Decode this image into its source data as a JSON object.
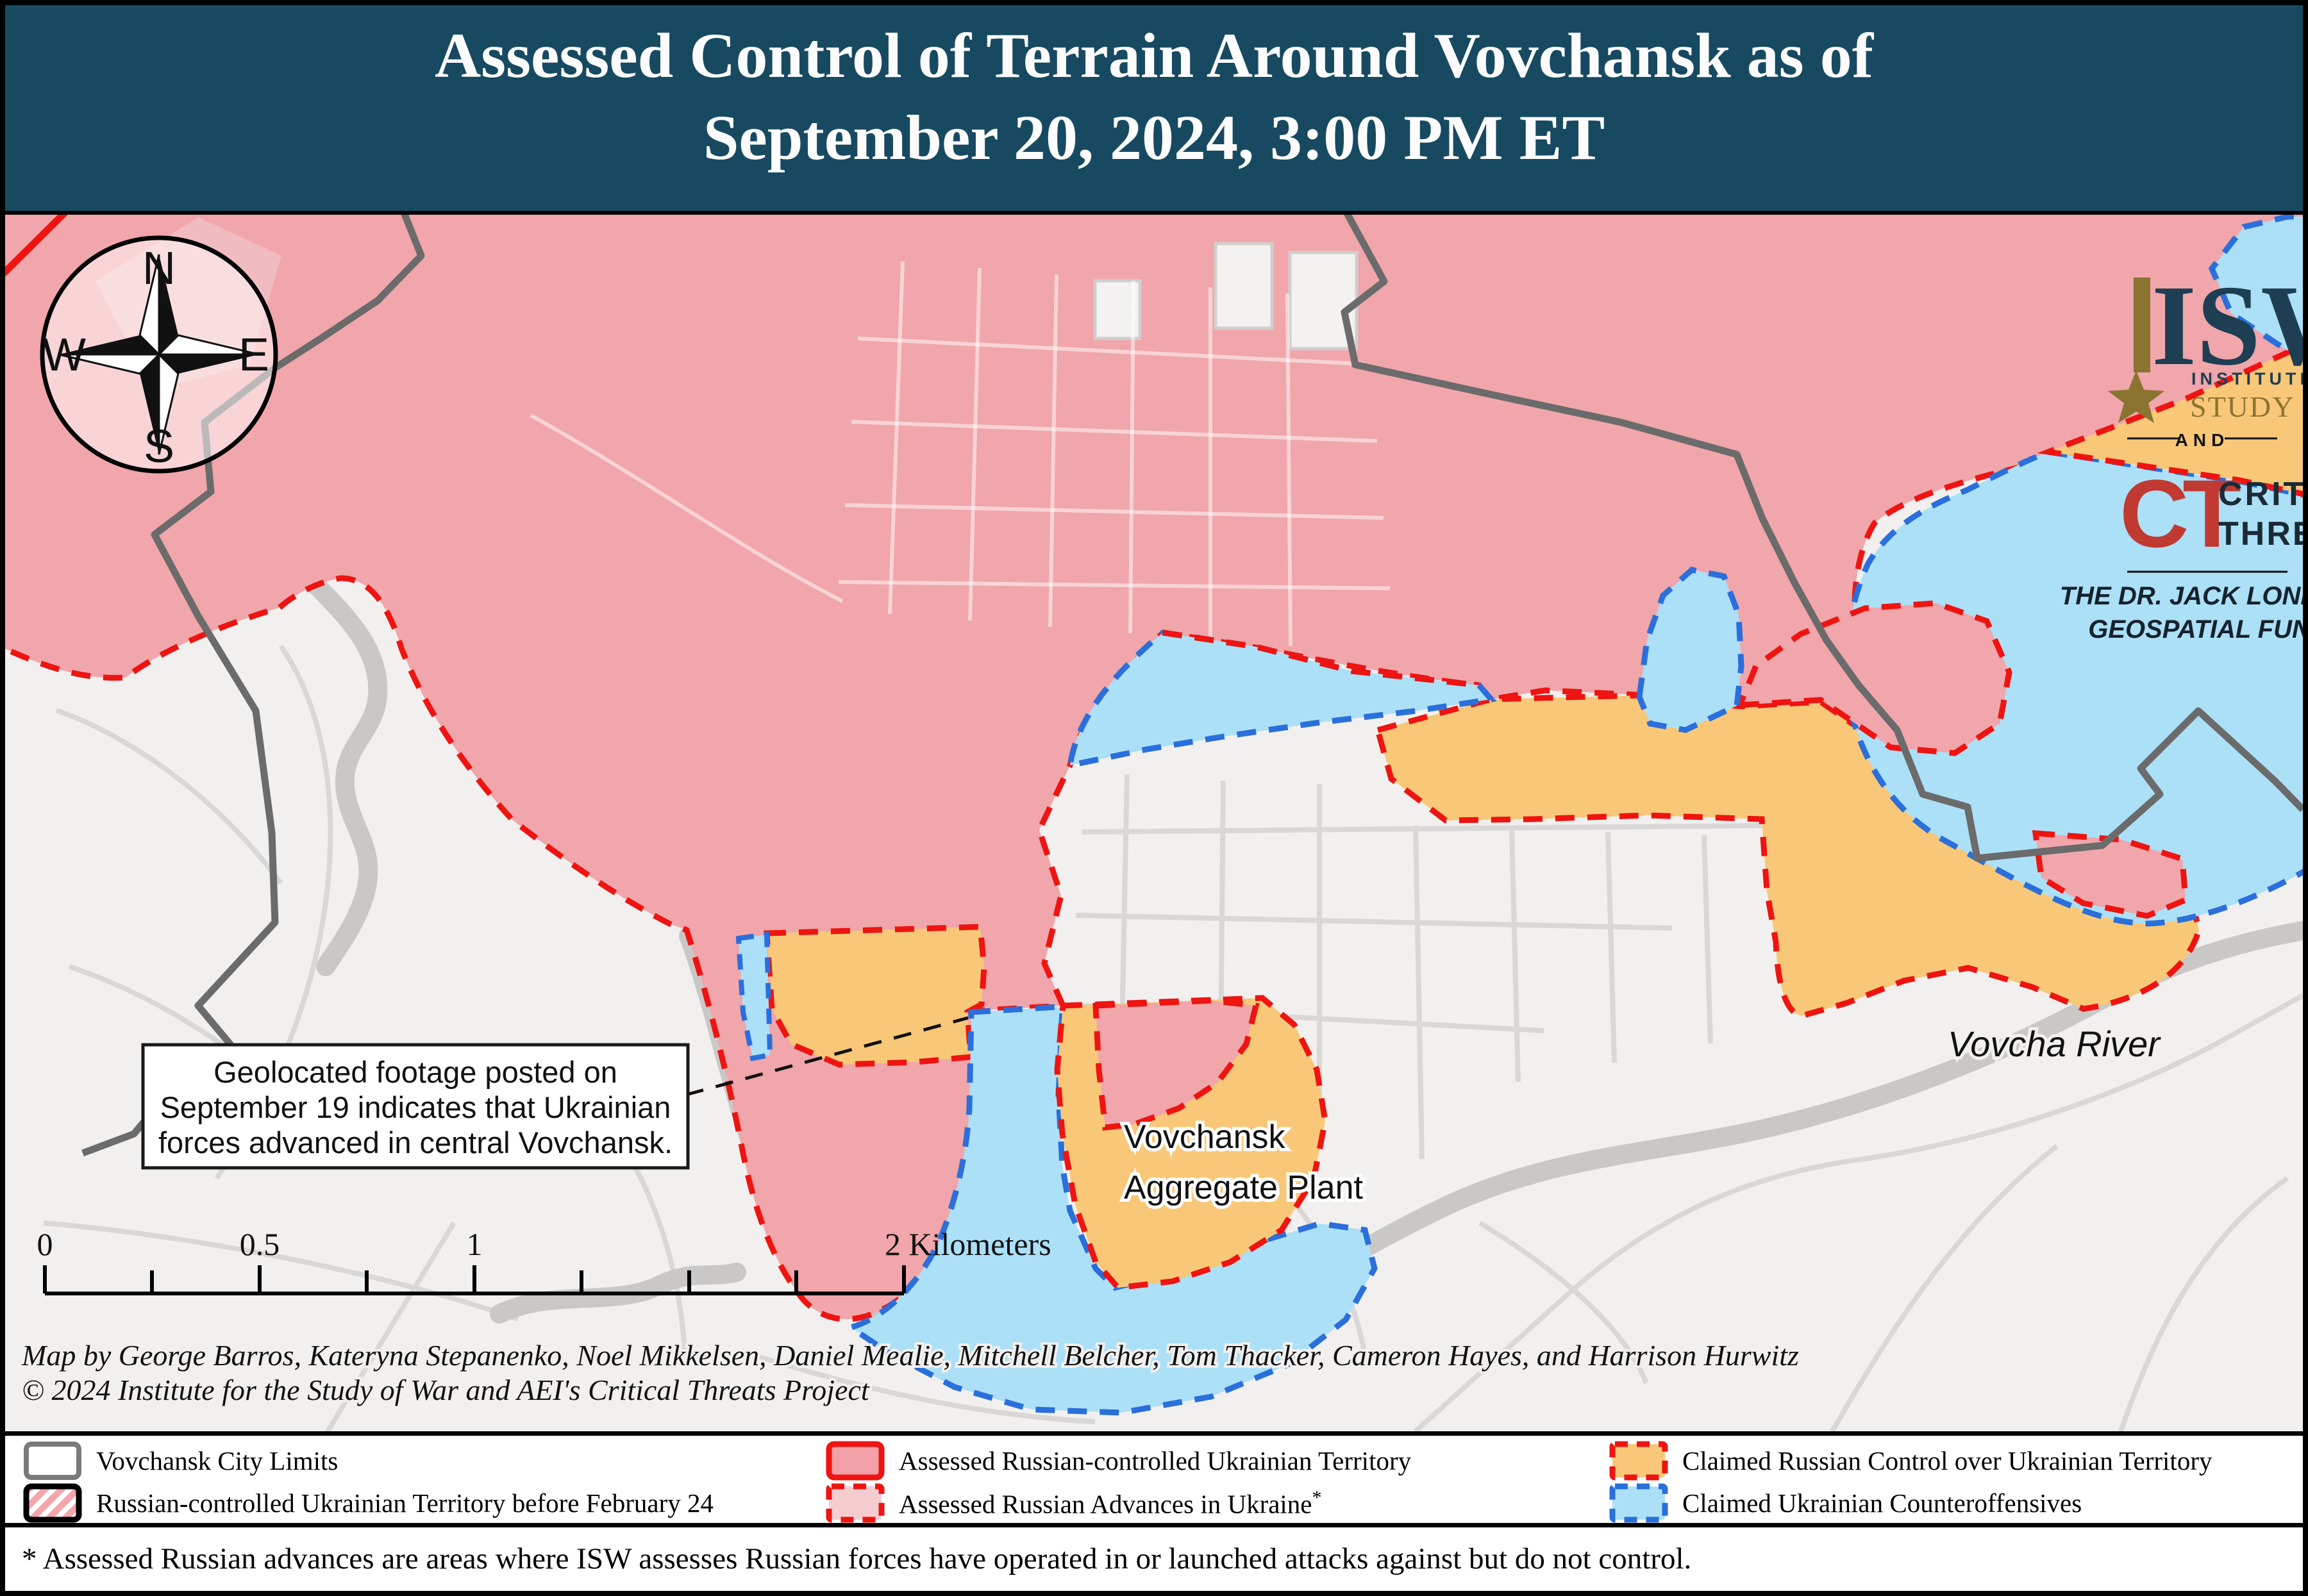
{
  "title": {
    "line1": "Assessed Control of Terrain Around Vovchansk as of",
    "line2": "September 20, 2024, 3:00 PM ET"
  },
  "logos": {
    "isw_acronym": "ISW",
    "isw_line1": "INSTITUTE FOR THE",
    "isw_line2": "STUDY OF WAR",
    "and_label": "AND",
    "ct_acronym": "CT",
    "ct_line1": "CRITICAL",
    "ct_line2": "THREATS",
    "fund_line1": "THE DR. JACK LONDON",
    "fund_line2": "GEOSPATIAL FUND"
  },
  "compass": {
    "n": "N",
    "e": "E",
    "s": "S",
    "w": "W"
  },
  "map_labels": {
    "plant_line1": "Vovchansk",
    "plant_line2": "Aggregate Plant",
    "river": "Vovcha River"
  },
  "callout": {
    "line1": "Geolocated footage posted on",
    "line2": "September 19 indicates that Ukrainian",
    "line3": "forces advanced in central Vovchansk."
  },
  "scale_bar": {
    "t0": "0",
    "t05": "0.5",
    "t1": "1",
    "t2": "2 Kilometers"
  },
  "attribution": {
    "line1": "Map by George Barros, Kateryna Stepanenko, Noel Mikkelsen, Daniel Mealie, Mitchell Belcher, Tom Thacker, Cameron Hayes, and Harrison Hurwitz",
    "line2": "© 2024 Institute for the Study of War and AEI's Critical Threats Project"
  },
  "legend": {
    "items": [
      {
        "label": "Vovchansk City Limits",
        "fill": "#ffffff",
        "border": "#7a7a7a",
        "border_style": "solid"
      },
      {
        "label": "Russian-controlled Ukrainian Territory before February 24",
        "fill": "#f2a6ab",
        "border": "#000000",
        "border_style": "solid-hatched"
      },
      {
        "label": "Assessed Russian-controlled Ukrainian Territory",
        "fill": "#f0a0a6",
        "border": "#ee1411",
        "border_style": "solid"
      },
      {
        "label": "Assessed Russian Advances in Ukraine",
        "label_suffix": "*",
        "fill": "#f5cdd1",
        "border": "#ee1411",
        "border_style": "dashed"
      },
      {
        "label": "Claimed Russian Control over Ukrainian Territory",
        "fill": "#f8c878",
        "border": "#ee1411",
        "border_style": "dashed"
      },
      {
        "label": "Claimed Ukrainian Counteroffensives",
        "fill": "#abe0f7",
        "border": "#2a6fdb",
        "border_style": "dashed"
      }
    ]
  },
  "footnote": "* Assessed Russian advances are areas where ISW assesses Russian forces have operated in or launched attacks against but do not control.",
  "colors": {
    "banner": "#174a61",
    "russian_controlled": "#f0a6ab",
    "assessed_advances": "#f5cdd1",
    "claimed_russian": "#f8c878",
    "claimed_ukrainian": "#abe0f7",
    "red_line": "#ee1411",
    "blue_line": "#2a6fdb",
    "city_limits": "#6b6b6b",
    "map_background": "#f1f0ef",
    "gold": "#8a7430",
    "navy": "#1d3e53",
    "ct_red": "#c03a32"
  }
}
